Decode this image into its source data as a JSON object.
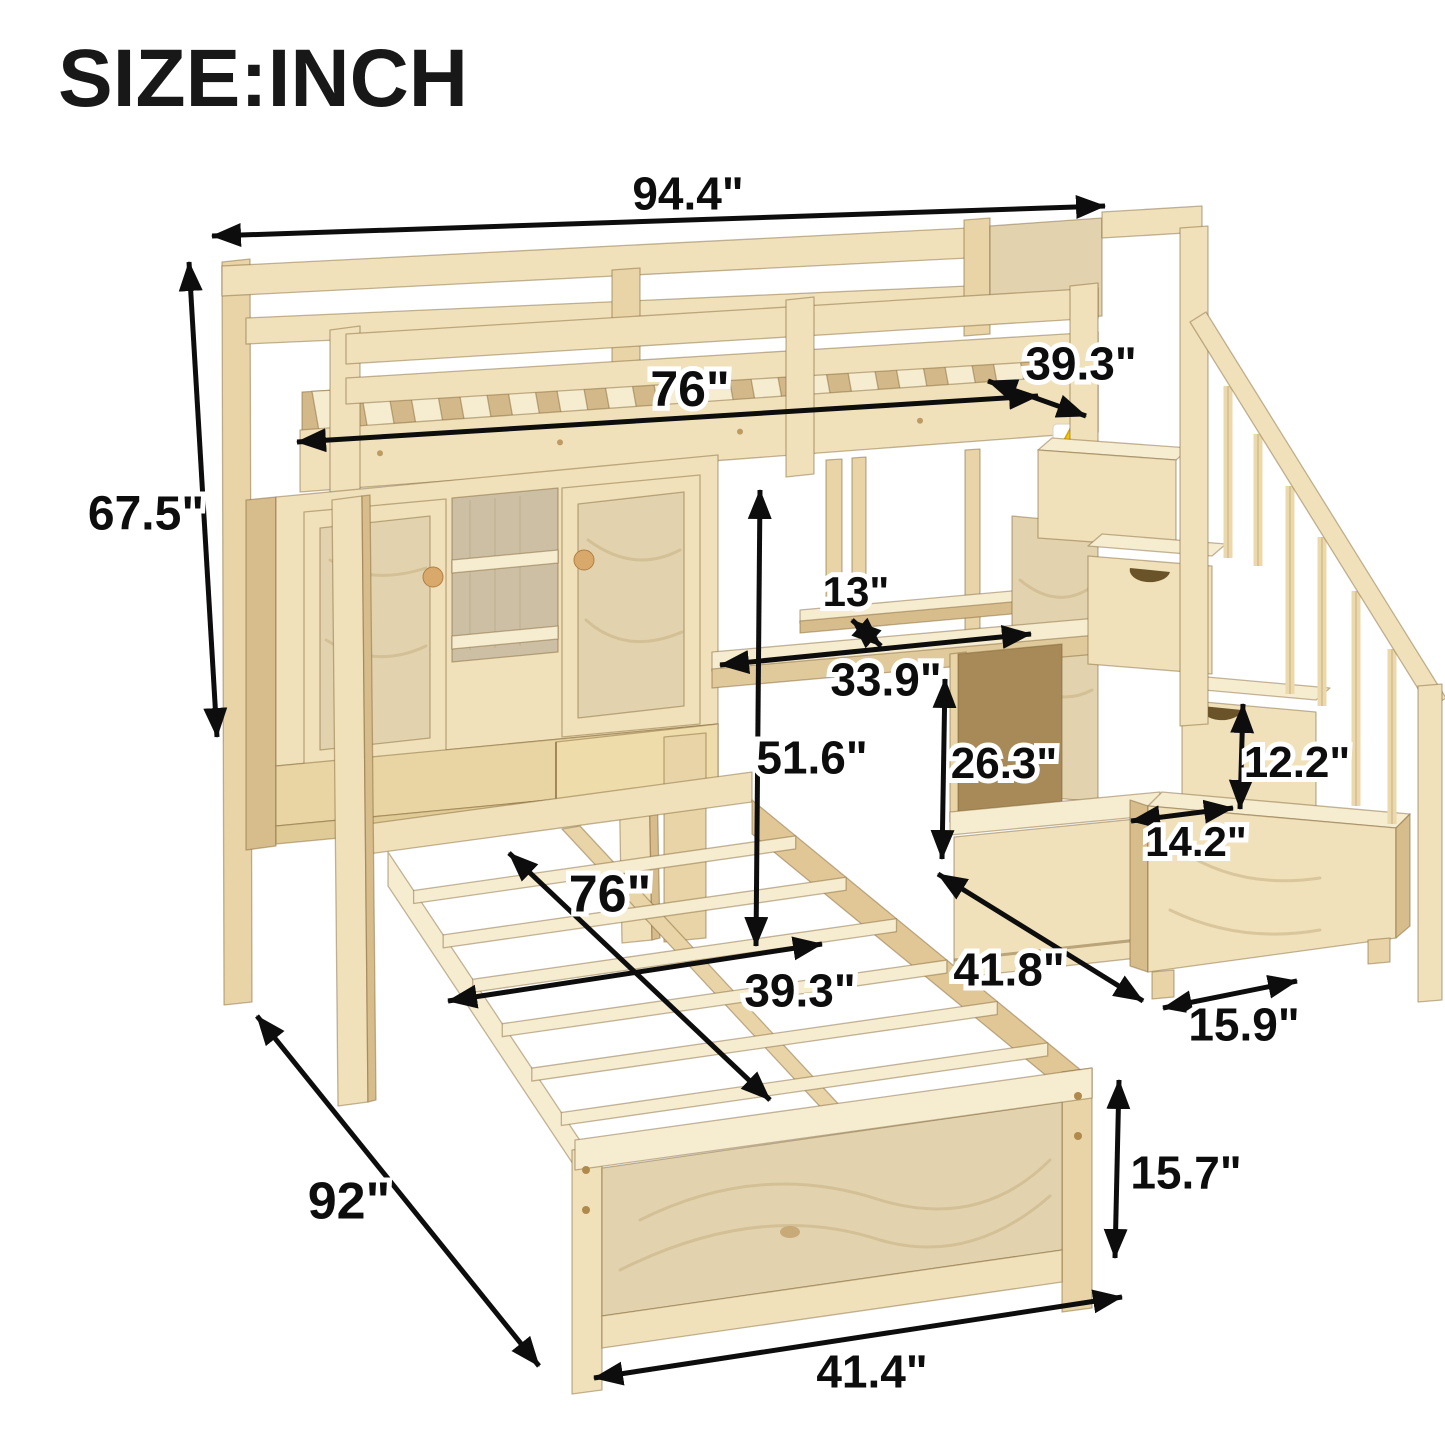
{
  "title": "SIZE:INCH",
  "unit": "inch",
  "colors": {
    "background": "#ffffff",
    "arrow": "#0d0d0d",
    "label_text": "#0d0d0d",
    "label_outline": "#ffffff",
    "wood_face": "#f0e1ba",
    "wood_light": "#f6ecd0",
    "wood_mid": "#e8d4a6",
    "wood_dark": "#d8bd8c",
    "wood_deep": "#c2a371",
    "wood_recess": "#a78a58",
    "plywood": "#e2d3ae",
    "sticker_yellow": "#f6c700"
  },
  "warning_sticker": {
    "present": true,
    "symbol": "!",
    "x": 1053,
    "y": 424
  },
  "dimensions": [
    {
      "id": "total-width",
      "label": "94.4\"",
      "value_in": 94.4,
      "text": {
        "x": 688,
        "y": 193,
        "size": 46
      },
      "arrow": {
        "x1": 212,
        "y1": 236,
        "x2": 1105,
        "y2": 206
      }
    },
    {
      "id": "loft-length",
      "label": "76\"",
      "value_in": 76,
      "text": {
        "x": 690,
        "y": 388,
        "size": 50
      },
      "arrow": {
        "x1": 297,
        "y1": 442,
        "x2": 1038,
        "y2": 396
      }
    },
    {
      "id": "loft-width",
      "label": "39.3\"",
      "value_in": 39.3,
      "text": {
        "x": 1081,
        "y": 363,
        "size": 46
      },
      "arrow": {
        "x1": 988,
        "y1": 381,
        "x2": 1086,
        "y2": 416
      }
    },
    {
      "id": "total-height",
      "label": "67.5\"",
      "value_in": 67.5,
      "text": {
        "x": 146,
        "y": 512,
        "size": 48
      },
      "arrow": {
        "x1": 189,
        "y1": 262,
        "x2": 217,
        "y2": 737
      }
    },
    {
      "id": "shelf-depth",
      "label": "13\"",
      "value_in": 13,
      "text": {
        "x": 856,
        "y": 591,
        "size": 42
      },
      "arrow": {
        "x1": 852,
        "y1": 620,
        "x2": 881,
        "y2": 646
      }
    },
    {
      "id": "desk-width",
      "label": "33.9\"",
      "value_in": 33.9,
      "text": {
        "x": 886,
        "y": 679,
        "size": 46
      },
      "arrow": {
        "x1": 720,
        "y1": 665,
        "x2": 1031,
        "y2": 634
      }
    },
    {
      "id": "clearance-height",
      "label": "51.6\"",
      "value_in": 51.6,
      "text": {
        "x": 812,
        "y": 757,
        "size": 46
      },
      "arrow": {
        "x1": 760,
        "y1": 490,
        "x2": 756,
        "y2": 946
      }
    },
    {
      "id": "cubby-height",
      "label": "26.3\"",
      "value_in": 26.3,
      "text": {
        "x": 1004,
        "y": 762,
        "size": 44
      },
      "arrow": {
        "x1": 945,
        "y1": 679,
        "x2": 942,
        "y2": 859
      }
    },
    {
      "id": "step-height",
      "label": "12.2\"",
      "value_in": 12.2,
      "text": {
        "x": 1297,
        "y": 761,
        "size": 44
      },
      "arrow": {
        "x1": 1243,
        "y1": 704,
        "x2": 1240,
        "y2": 809
      }
    },
    {
      "id": "step-depth",
      "label": "14.2\"",
      "value_in": 14.2,
      "text": {
        "x": 1196,
        "y": 841,
        "size": 42
      },
      "arrow": {
        "x1": 1131,
        "y1": 821,
        "x2": 1233,
        "y2": 808
      }
    },
    {
      "id": "stair-base-depth",
      "label": "41.8\"",
      "value_in": 41.8,
      "text": {
        "x": 1009,
        "y": 969,
        "size": 46
      },
      "arrow": {
        "x1": 938,
        "y1": 874,
        "x2": 1143,
        "y2": 1001
      }
    },
    {
      "id": "stair-base-width",
      "label": "15.9\"",
      "value_in": 15.9,
      "text": {
        "x": 1244,
        "y": 1024,
        "size": 46
      },
      "arrow": {
        "x1": 1163,
        "y1": 1008,
        "x2": 1297,
        "y2": 981
      }
    },
    {
      "id": "bed-length",
      "label": "76\"",
      "value_in": 76,
      "text": {
        "x": 610,
        "y": 893,
        "size": 52
      },
      "arrow": {
        "x1": 509,
        "y1": 853,
        "x2": 770,
        "y2": 1100
      }
    },
    {
      "id": "bed-width",
      "label": "39.3\"",
      "value_in": 39.3,
      "text": {
        "x": 800,
        "y": 990,
        "size": 46
      },
      "arrow": {
        "x1": 448,
        "y1": 1001,
        "x2": 822,
        "y2": 944
      }
    },
    {
      "id": "total-depth",
      "label": "92\"",
      "value_in": 92,
      "text": {
        "x": 349,
        "y": 1200,
        "size": 52
      },
      "arrow": {
        "x1": 257,
        "y1": 1016,
        "x2": 539,
        "y2": 1366
      }
    },
    {
      "id": "footboard-width",
      "label": "41.4\"",
      "value_in": 41.4,
      "text": {
        "x": 872,
        "y": 1371,
        "size": 46
      },
      "arrow": {
        "x1": 594,
        "y1": 1378,
        "x2": 1122,
        "y2": 1297
      }
    },
    {
      "id": "footboard-height",
      "label": "15.7\"",
      "value_in": 15.7,
      "text": {
        "x": 1186,
        "y": 1172,
        "size": 46
      },
      "arrow": {
        "x1": 1119,
        "y1": 1080,
        "x2": 1115,
        "y2": 1258
      }
    }
  ]
}
